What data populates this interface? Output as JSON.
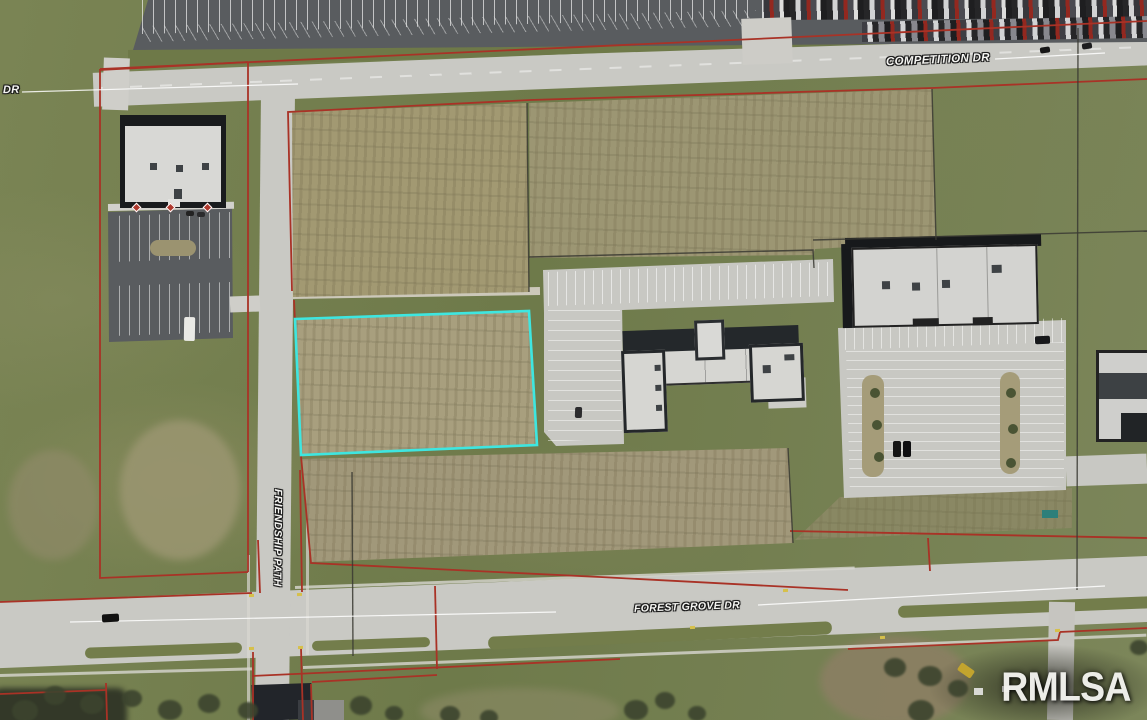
{
  "map": {
    "streets": {
      "competition": "COMPETITION DR",
      "partial_dr": "DR",
      "friendship": "FRIENDSHIP PATH",
      "forest_grove": "FOREST GROVE DR"
    },
    "watermark": "RMLSA",
    "colors": {
      "parcel_line": "#a93226",
      "highlight_parcel": "#3ee6e0",
      "black_line": "#3a3a33",
      "road": "#c9c9c4",
      "asphalt_dark": "#595c5f",
      "grass": "#76804e",
      "dirt_field": "#a29972",
      "label_text": "#f5f5f2",
      "watermark_text": "#f3f3ef"
    }
  }
}
